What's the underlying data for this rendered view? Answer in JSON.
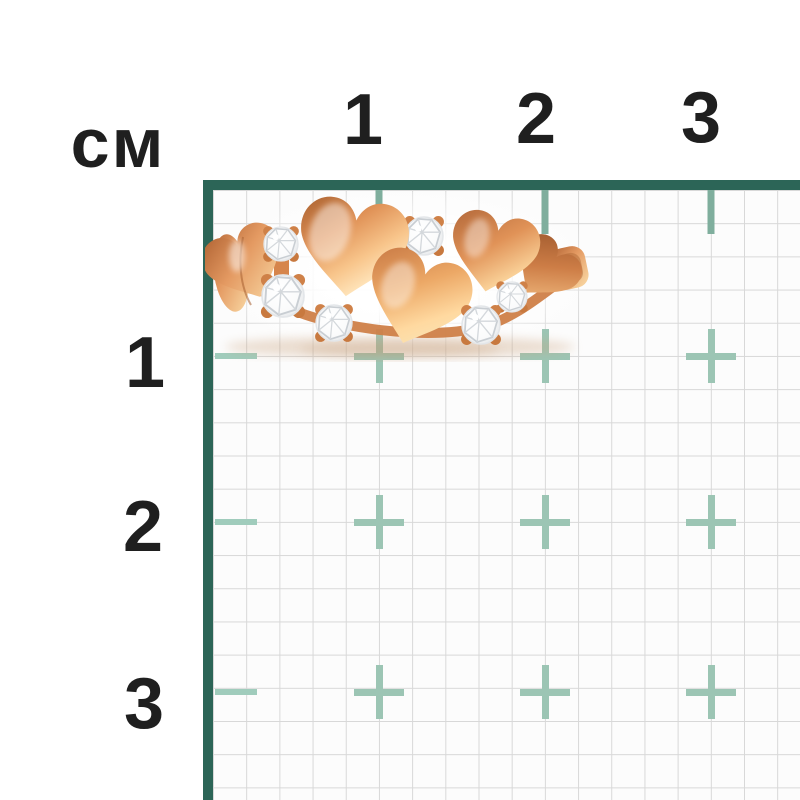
{
  "ruler": {
    "unit_label": "см",
    "top_labels": [
      "1",
      "2",
      "3"
    ],
    "left_labels": [
      "1",
      "2",
      "3"
    ],
    "frame_color": "#2c6557",
    "grid_line_color": "#d8d8d8",
    "grid_bg_color": "#fcfcfc",
    "tick_top_color": "#7fae9d",
    "tick_left_color": "#a0ccbc",
    "crosshair_color": "#9cc5b4",
    "label_color": "#1f1f1f",
    "cm_in_px": 166,
    "small_cells_per_cm": 5
  },
  "photo": {
    "subject": "rose gold ring with heart shapes and crystals",
    "gold_dark": "#a8602f",
    "gold_mid": "#e09257",
    "gold_light": "#ffe6bd",
    "gem_color": "#ffffff",
    "heart_count": 5,
    "crystal_count": 6
  }
}
